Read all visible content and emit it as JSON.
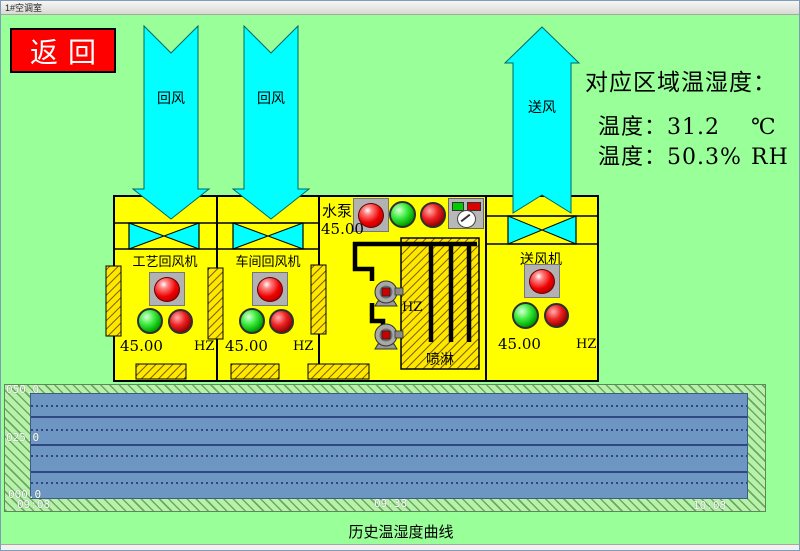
{
  "window": {
    "title": "1#空调室"
  },
  "nav": {
    "back_label": "返回"
  },
  "flows": {
    "return_air_1": "回风",
    "return_air_2": "回风",
    "supply_air": "送风"
  },
  "readout": {
    "title": "对应区域温湿度：",
    "temperature": {
      "label": "温度：",
      "value": "31.2",
      "unit": "℃"
    },
    "humidity": {
      "label": "温度：",
      "value": "50.3%",
      "unit": "RH"
    }
  },
  "units": {
    "process_return_fan": {
      "name": "工艺回风机",
      "freq": "45.00",
      "freq_unit": "HZ"
    },
    "workshop_return_fan": {
      "name": "车间回风机",
      "freq": "45.00",
      "freq_unit": "HZ"
    },
    "water_pump": {
      "name": "水泵",
      "freq": "45.00"
    },
    "spray": {
      "name": "喷淋",
      "freq_unit": "HZ"
    },
    "supply_fan": {
      "name": "送风机",
      "freq": "45.00",
      "freq_unit": "HZ"
    }
  },
  "trend": {
    "caption": "历史温湿度曲线",
    "y_labels": [
      "050.0",
      "025.0",
      "000.0"
    ],
    "x_labels": [
      "09:08",
      "09:38",
      "10:08"
    ]
  },
  "chart_data": {
    "type": "line",
    "title": "历史温湿度曲线",
    "x_labels": [
      "09:08",
      "09:38",
      "10:08"
    ],
    "ylim": [
      0,
      50
    ],
    "grid": "horizontal solid+dotted",
    "series": []
  },
  "colors": {
    "background": "#99ff99",
    "duct_cyan": "#00ffff",
    "equipment_yellow": "#ffff00",
    "back_button_red": "#ff0000",
    "plot_blue": "#6e96c3"
  }
}
